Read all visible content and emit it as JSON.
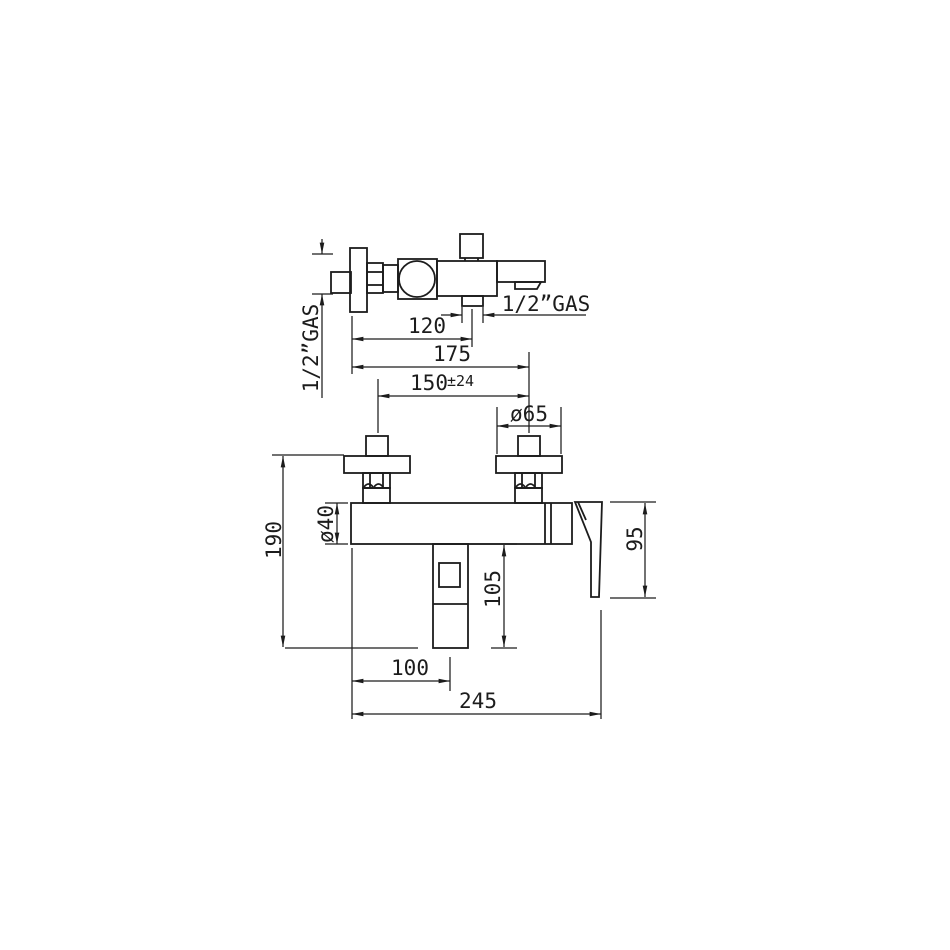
{
  "drawing": {
    "type": "faucet-dimensional-drawing",
    "line_color": "#1c1c1c",
    "background": "#ffffff",
    "labels": {
      "inlet": "1/2”GAS",
      "outlet": "1/2”GAS"
    },
    "dims": {
      "d120": "120",
      "d175": "175",
      "d150": "150",
      "d150_tol": "±24",
      "d65": "ø65",
      "d40": "ø40",
      "d190": "190",
      "d105": "105",
      "d95": "95",
      "d100": "100",
      "d245": "245"
    }
  }
}
